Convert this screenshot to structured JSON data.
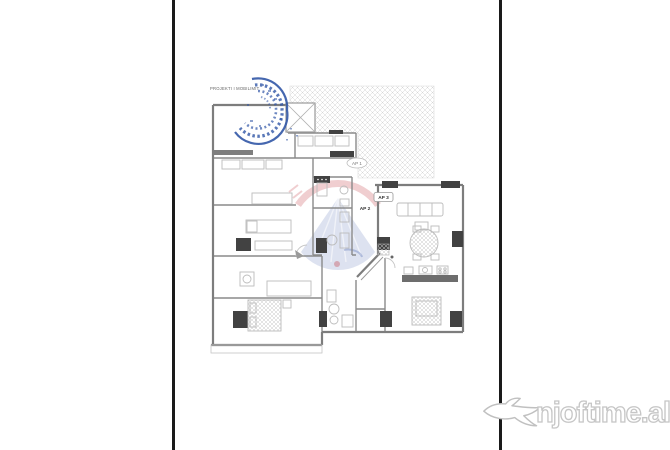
{
  "page": {
    "background": "#ffffff",
    "rule_color": "#1a1a1a"
  },
  "plan": {
    "title": "PROJEKTI I MOBILIMIT",
    "labels": {
      "ap1": "AP 1",
      "ap2": "AP 2",
      "ap3": "AP 3"
    },
    "colors": {
      "wall": "#8a8a8a",
      "dark_fill": "#424242",
      "furniture": "#bcbcbc",
      "hatch": "#d6d6d6",
      "stamp_blue": "#3156a6",
      "emblem_red": "#c23b45",
      "emblem_blue": "#5570b5"
    }
  },
  "watermark": {
    "text": "njoftime.al",
    "icon": "fish-icon",
    "text_color": "#ffffff",
    "outline_color": "#c6c6c6"
  }
}
